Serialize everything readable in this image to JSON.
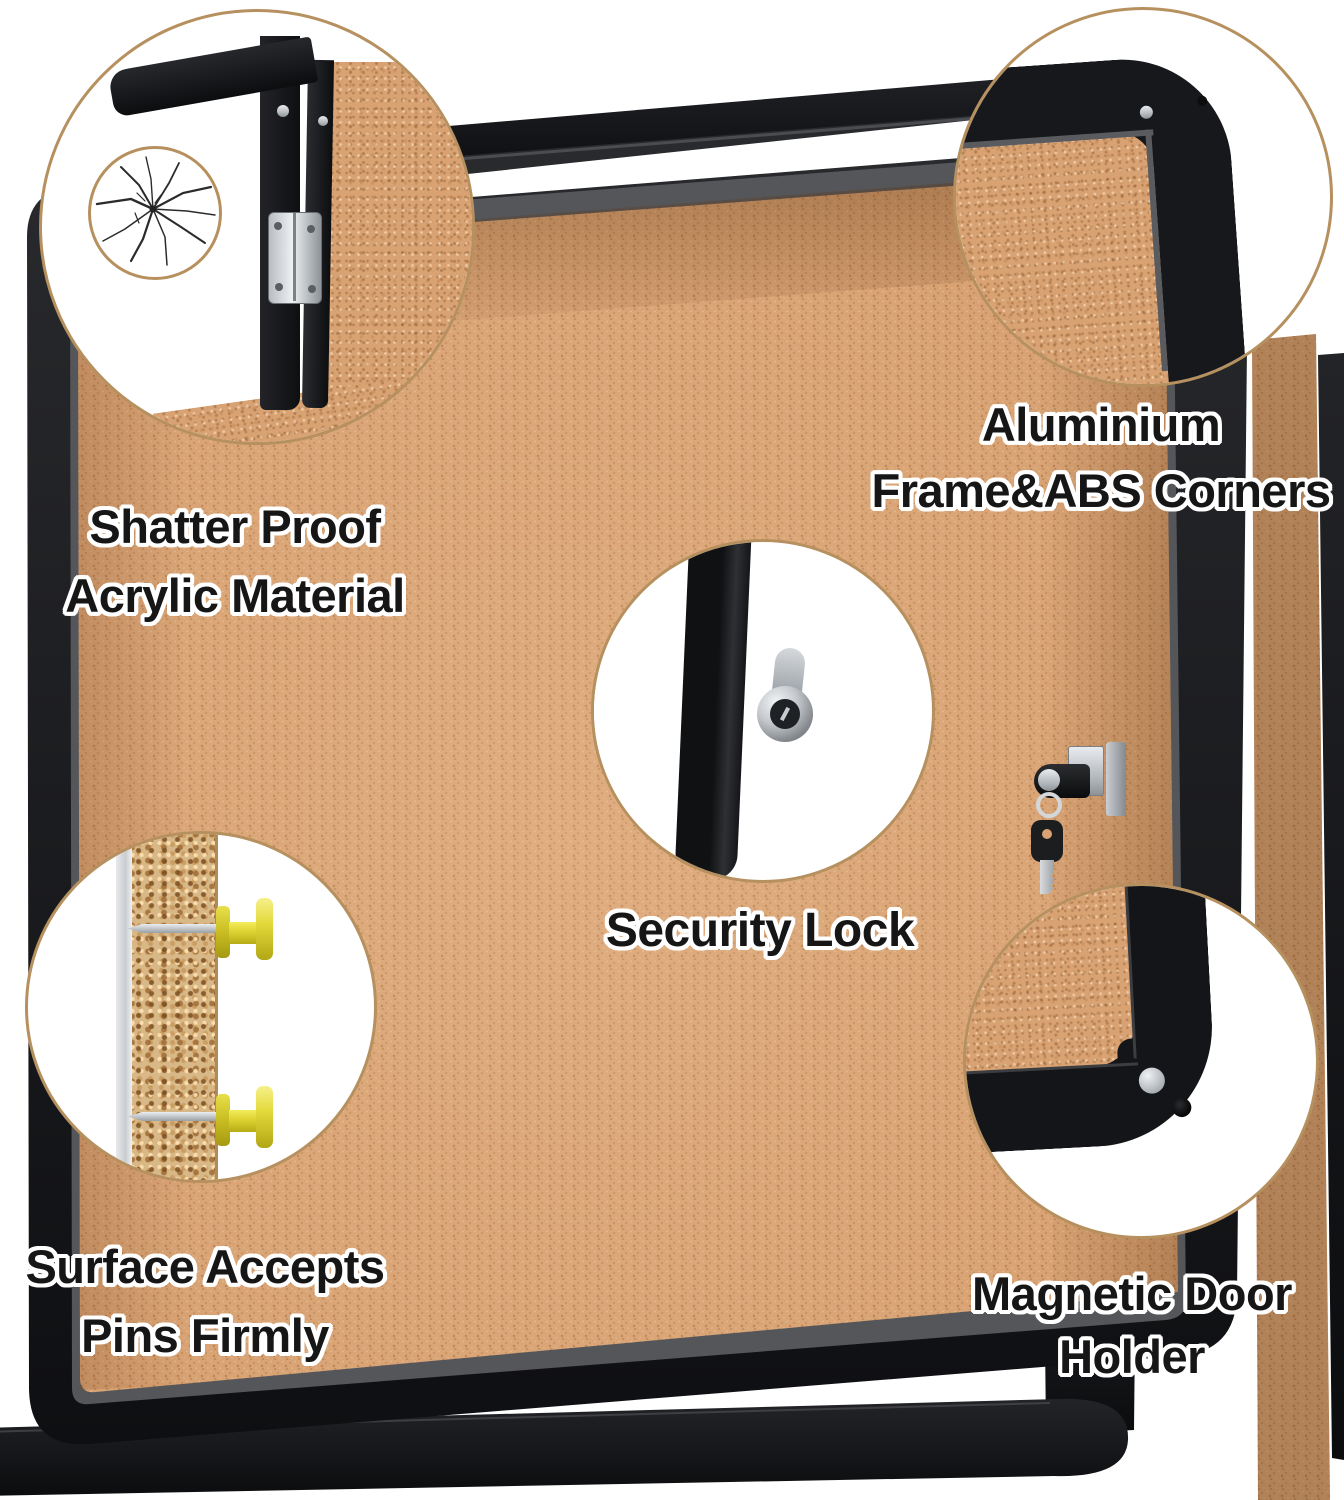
{
  "meta": {
    "description": "Enclosed cork bulletin board feature image with five zoom callouts",
    "background": "#ffffff"
  },
  "colors": {
    "cork": "#d8a273",
    "cork_dark": "#c08a5c",
    "frame_black": "#17181b",
    "inner_gray": "#55565a",
    "circle_border": "#b6905e",
    "text": "#161616",
    "text_outline": "#ffffff",
    "pin_yellow": "#e8dd3a",
    "metal_silver": "#c9ccd1"
  },
  "callouts": [
    {
      "id": "acrylic",
      "icon": "shatterproof-crack-detail",
      "lines": [
        "Shatter Proof",
        "Acrylic Material"
      ]
    },
    {
      "id": "corners",
      "icon": "frame-corner-detail",
      "lines": [
        "Aluminium",
        "Frame&ABS Corners"
      ]
    },
    {
      "id": "lock",
      "icon": "security-lock-detail",
      "lines": [
        "Security Lock"
      ]
    },
    {
      "id": "pins",
      "icon": "cork-pins-detail",
      "lines": [
        "Surface Accepts",
        "Pins Firmly"
      ]
    },
    {
      "id": "magnet",
      "icon": "magnetic-holder-detail",
      "lines": [
        "Magnetic Door",
        "Holder"
      ]
    }
  ]
}
